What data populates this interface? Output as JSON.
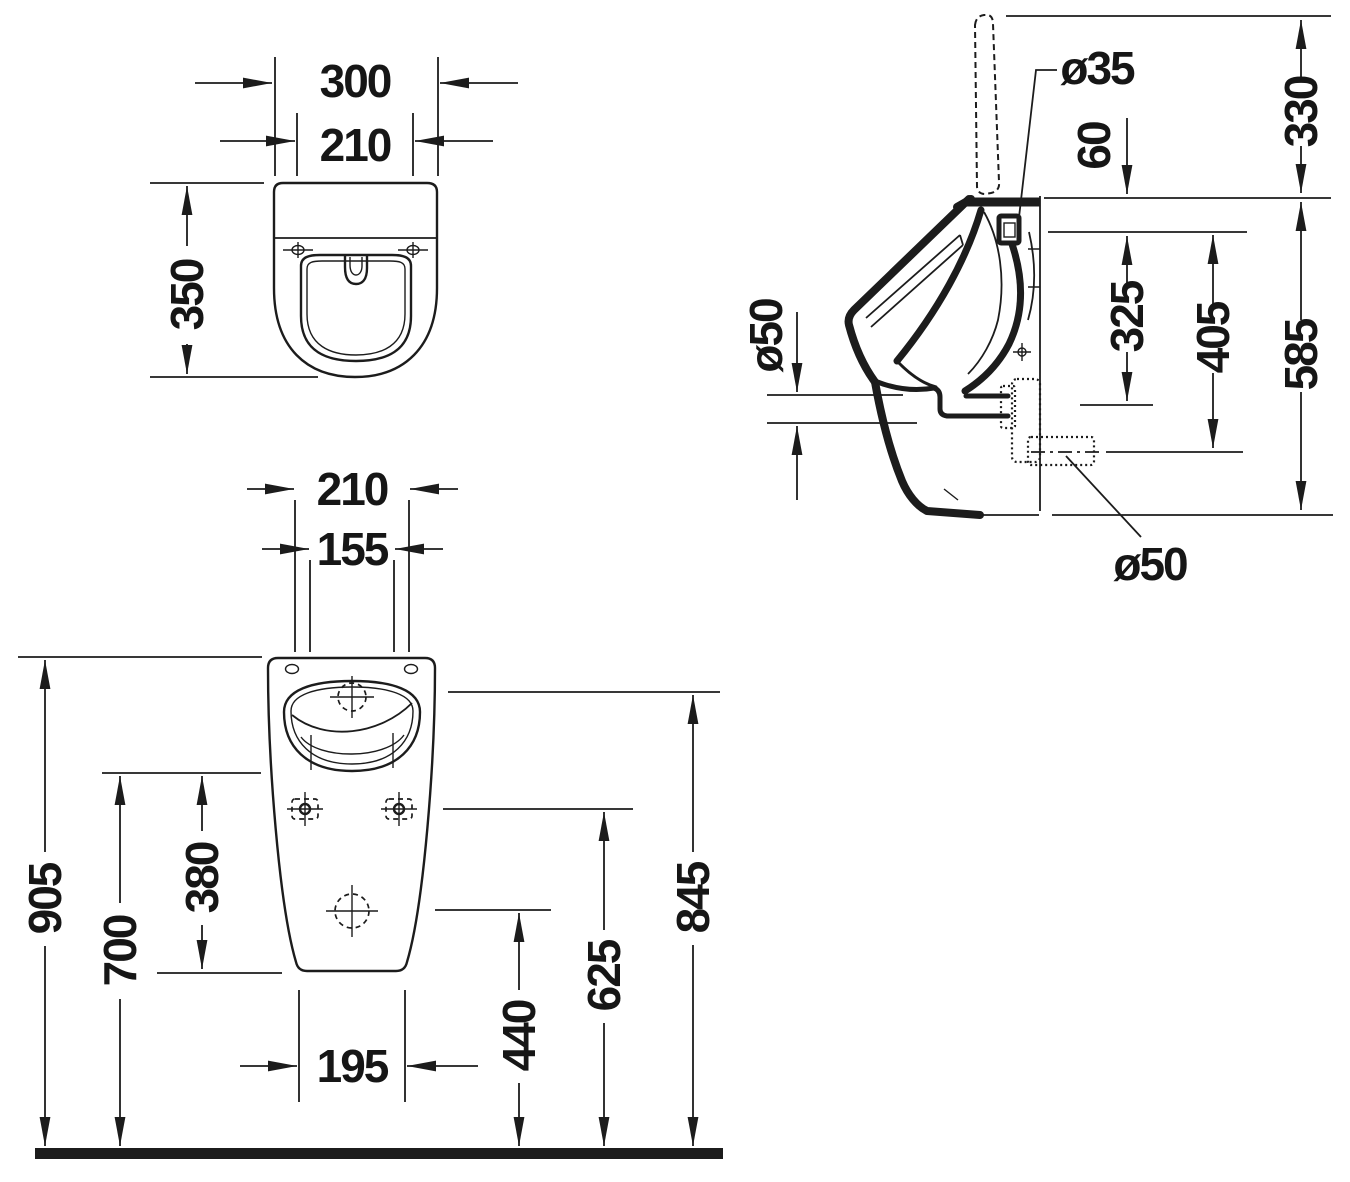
{
  "drawing_type": "technical dimensional drawing, sanitary ware (urinal), three orthographic views",
  "colors": {
    "ink": "#1c1c1c",
    "background": "#ffffff"
  },
  "views": {
    "top": {
      "dims": {
        "outer_width": "300",
        "inner_width": "210",
        "depth": "350"
      }
    },
    "front": {
      "dims": {
        "top_width": "210",
        "rim_width": "155",
        "overall_height": "905",
        "basin_underside_height": "700",
        "lower_body_height": "380",
        "bottom_width": "195",
        "outlet_height": "440",
        "fixing_height": "625",
        "rim_height": "845"
      }
    },
    "side": {
      "dims": {
        "inlet_diameter": "ø35",
        "inlet_drop": "60",
        "lid_height": "330",
        "rear_outlet_diameter": "ø50",
        "inlet_to_fixing": "325",
        "inlet_to_outlet": "405",
        "mount_height": "585",
        "bottom_outlet_diameter": "ø50"
      }
    }
  }
}
